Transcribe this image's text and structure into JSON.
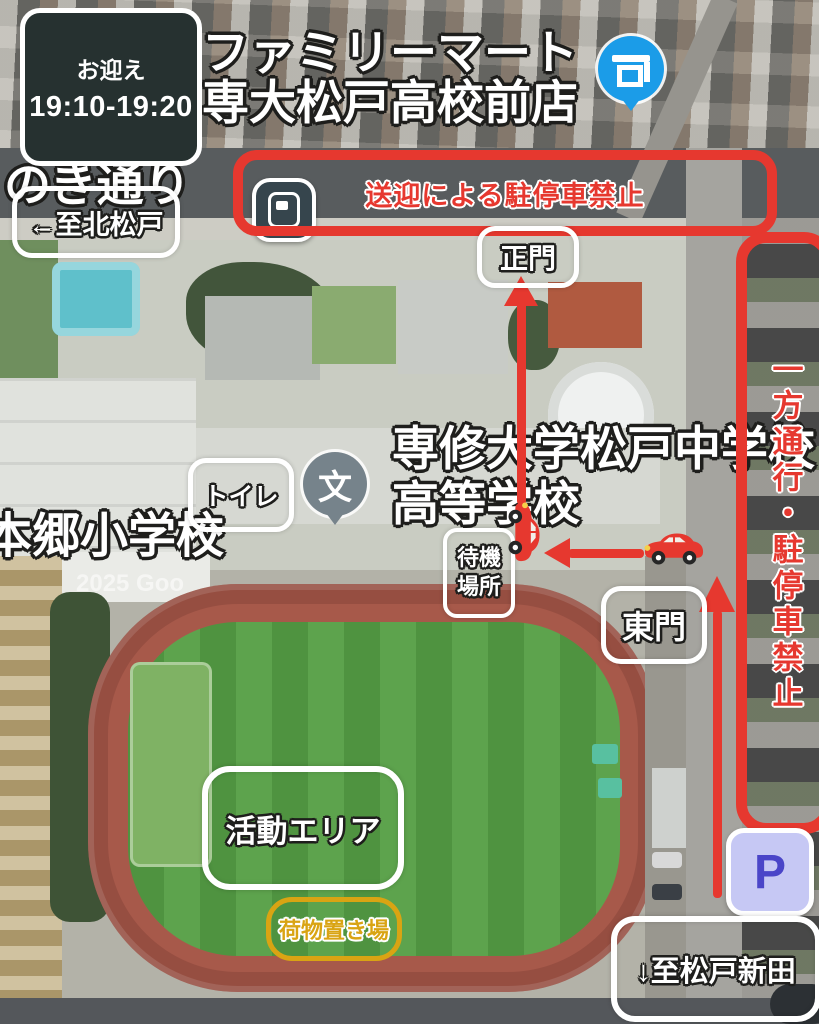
{
  "colors": {
    "annotation_red": "#e6382f",
    "highlight_yellow": "#d9a413",
    "pickup_box_bg": "#263130",
    "parking_icon_bg": "#c6c8f4",
    "parking_icon_letter": "#4a45c8",
    "store_pin_blue": "#1b9ce8",
    "transit_icon_dark": "#36454d",
    "school_pin_grey": "#76838b"
  },
  "map_labels": {
    "street": "のき通り",
    "store_name_line1": "ファミリーマート",
    "store_name_line2": "専大松戸高校前店",
    "elementary_school": "本郷小学校",
    "school_name_line1": "専修大学松戸中学校",
    "school_name_line2": "高等学校",
    "school_pin_glyph": "文",
    "watermark": "2025 Goo"
  },
  "annotations": {
    "pickup_title": "お迎え",
    "pickup_time": "19:10-19:20",
    "no_stopping_banner": "送迎による駐停車禁止",
    "to_kita_matsudo": "←至北松戸",
    "main_gate": "正門",
    "one_way_no_parking": "一方通行・駐停車禁止",
    "toilet": "トイレ",
    "waiting_line1": "待機",
    "waiting_line2": "場所",
    "east_gate": "東門",
    "activity_area": "活動エリア",
    "luggage_area": "荷物置き場",
    "to_matsudo_shinden": "↓至松戸新田",
    "parking_mark": "P"
  }
}
